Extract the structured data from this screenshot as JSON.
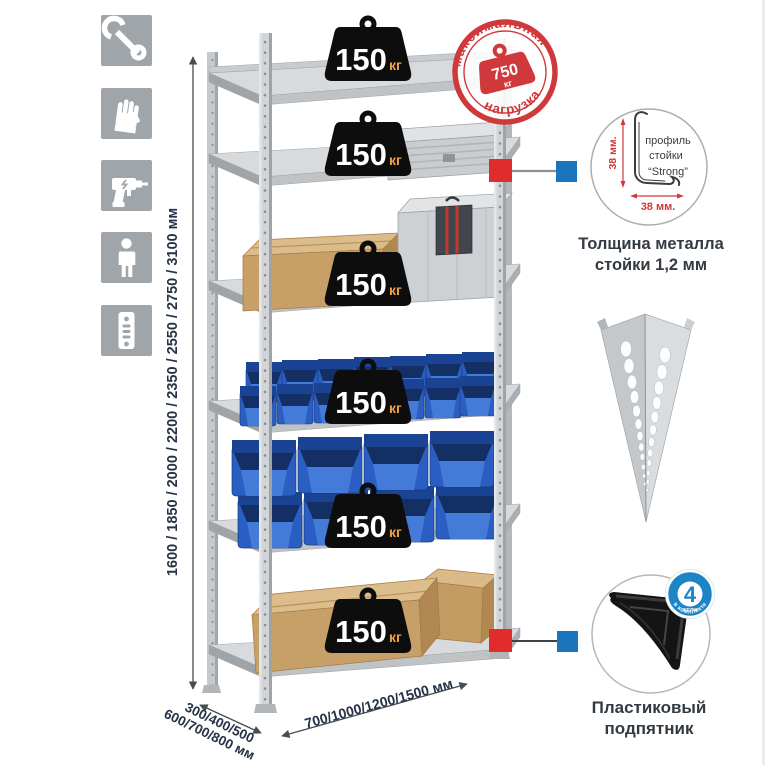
{
  "sidebar": {
    "icons": [
      {
        "name": "wrench"
      },
      {
        "name": "gloves"
      },
      {
        "name": "drill"
      },
      {
        "name": "person"
      },
      {
        "name": "upright"
      }
    ]
  },
  "dimensions": {
    "height": "1600 / 1850 / 2000 / 2200 / 2350 / 2550 / 2750 / 3100 мм",
    "depth_line1": "300/400/500",
    "depth_line2": "600/700/800 мм",
    "width": "700/1000/1200/1500 мм"
  },
  "shelf_load": {
    "value": "150",
    "unit": "кг",
    "shelf_count": 6
  },
  "max_load_stamp": {
    "arc_top": "максимальная",
    "arc_bottom": "нагрузка",
    "value": "750",
    "unit": "кг"
  },
  "profile_detail": {
    "label_line1": "профиль",
    "label_line2": "стойки",
    "label_line3": "“Strong”",
    "dim_height": "38 мм.",
    "dim_width": "38 мм.",
    "caption_line1": "Толщина металла",
    "caption_line2": "стойки 1,2 мм"
  },
  "foot_detail": {
    "badge_number": "4",
    "badge_small_text": "штуки",
    "badge_arc_text": "в комплекте",
    "caption_line1": "Пластиковый",
    "caption_line2": "подпятник"
  },
  "colors": {
    "stamp_red": "#d0393b",
    "marker_red": "#e02c2c",
    "marker_blue": "#1b75bc",
    "badge_blue": "#1d84c5",
    "bin_blue": "#2a5ec2",
    "weight_black": "#0d0d0d",
    "weight_unit_orange": "#f0a243",
    "dim_text_navy": "#263248",
    "icon_bg_gray": "#a0a5a9"
  }
}
